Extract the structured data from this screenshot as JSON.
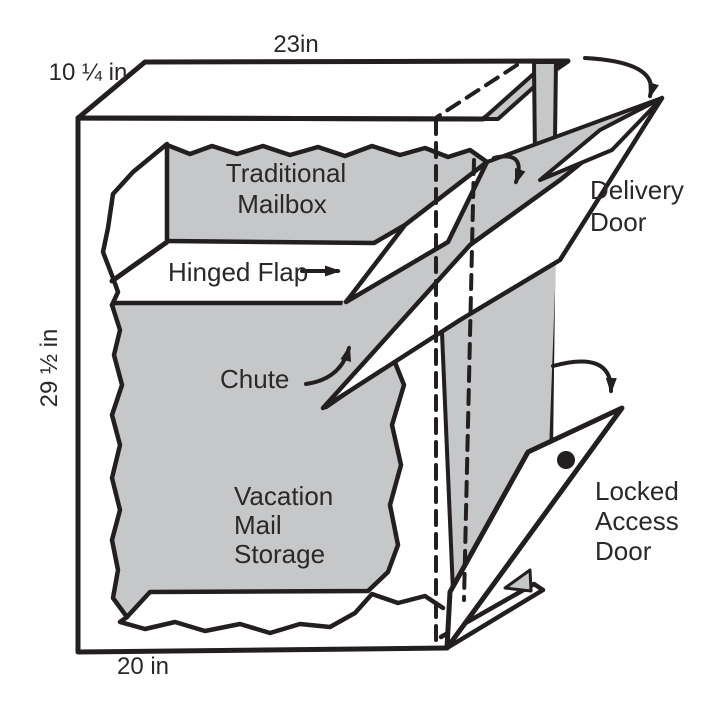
{
  "diagram": {
    "dimensions": {
      "top_width": "23in",
      "top_depth": "10 ¼ in",
      "height": "29 ½ in",
      "bottom_width": "20 in"
    },
    "labels": {
      "traditional_mailbox": [
        "Traditional",
        "Mailbox"
      ],
      "hinged_flap": "Hinged Flap",
      "chute": "Chute",
      "vacation_mail_storage": [
        "Vacation",
        "Mail",
        "Storage"
      ],
      "delivery_door": [
        "Delivery",
        "Door"
      ],
      "locked_access_door": [
        "Locked",
        "Access",
        "Door"
      ]
    },
    "colors": {
      "line": "#231f20",
      "panel_gray": "#c6c7c9",
      "text": "#2b2826",
      "background": "#ffffff"
    }
  }
}
